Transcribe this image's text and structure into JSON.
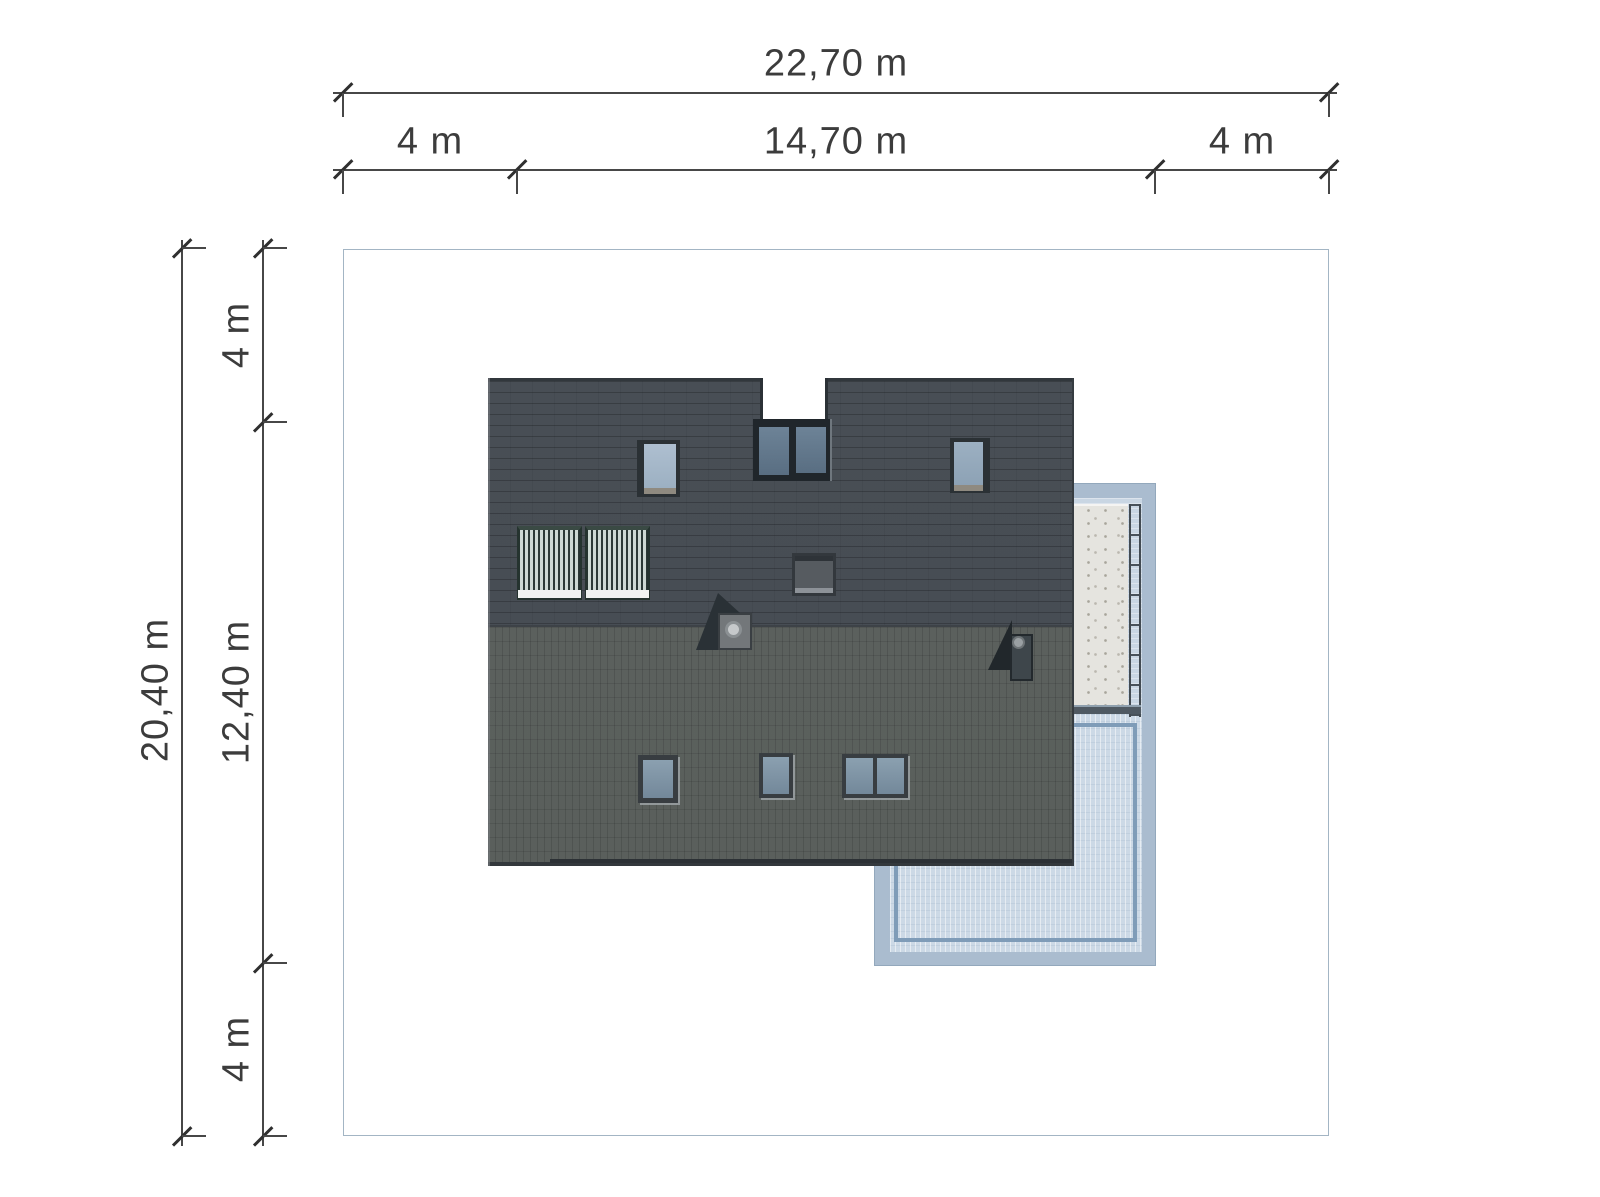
{
  "dimensions": {
    "top": {
      "total": "22,70 m",
      "segments": [
        "4 m",
        "14,70 m",
        "4 m"
      ]
    },
    "left": {
      "total": "20,40 m",
      "segments": [
        "4 m",
        "12,40 m",
        "4 m"
      ]
    }
  },
  "colors": {
    "background": "#ffffff",
    "dim_line": "#474747",
    "dim_text": "#3c3c3c",
    "plot_border": "#a3b5c4",
    "roof_upper": "#474d54",
    "roof_lower": "#5a5f5c",
    "roof_edge": "#31373c",
    "terrace_band": "#aabccf",
    "terrace_inner": "#c9d6e3",
    "water": "#ccd9e6",
    "concrete": "#e5e4df",
    "pool_outline": "#7f9cb8",
    "glass_blue": "#8ba0b0",
    "solar_tube": "#cdd9d3",
    "solar_dark": "#2b3935"
  }
}
